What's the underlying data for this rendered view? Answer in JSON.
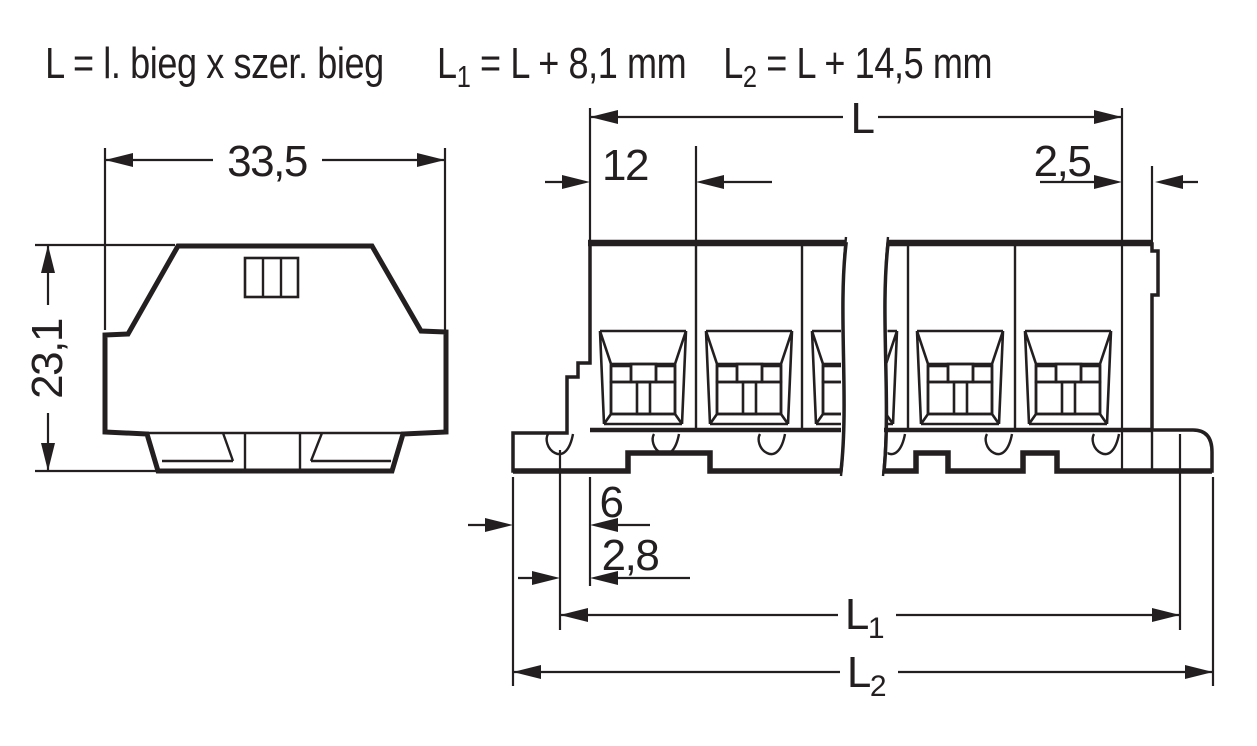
{
  "legend": {
    "relation": "L = l. bieg x szer. bieg",
    "l1_base": "L",
    "l1_sub": "1",
    "l1_eq": " = L + 8,1 mm",
    "l2_base": "L",
    "l2_sub": "2",
    "l2_eq": " = L + 14,5 mm"
  },
  "side_view": {
    "width_dim": "33,5",
    "height_dim": "23,1"
  },
  "front_view": {
    "length_dim": "L",
    "pitch_dim": "12",
    "end_section_dim": "2,5",
    "foot_dim": "6",
    "foot_offset_dim": "2,8",
    "l1_base": "L",
    "l1_sub": "1",
    "l2_base": "L",
    "l2_sub": "2"
  },
  "colors": {
    "body_gray": "#e8e9ea",
    "terminal_yellow": "#ffe100",
    "terminal_salmon": "#f8c591",
    "line_dark": "#231f20"
  }
}
